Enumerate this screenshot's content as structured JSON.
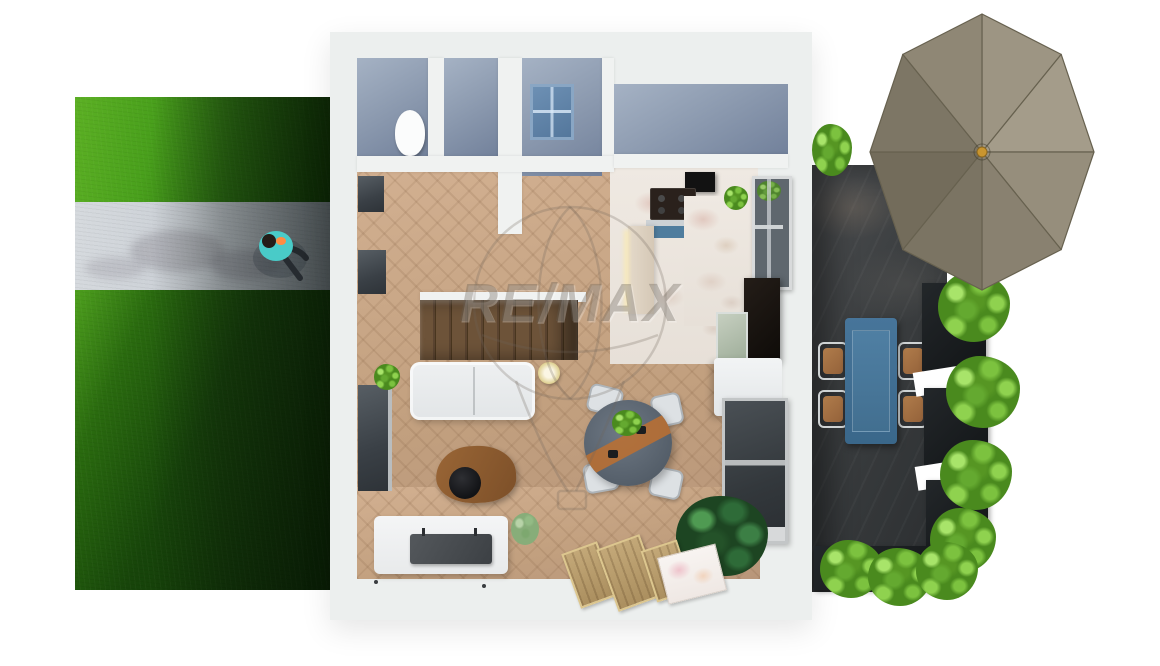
{
  "watermark": {
    "brand": "RE/MAX"
  },
  "scene": {
    "description": "Top-down 3D dollhouse render of a furnished ground floor with left garden lawn and concrete path, central apartment, right patio with outdoor dining set, hedges and a large parasol",
    "colors": {
      "background": "#ffffff",
      "grass_light": "#5cb024",
      "grass_dark": "#123f05",
      "path_concrete": "#c9ced4",
      "house_wall": "#ecefee",
      "room_blue_gray": "#8e9cb1",
      "wood_floor": "#c9a98c",
      "stair_wood": "#5b4430",
      "kitchen_marble": "#e9e2db",
      "patio_dark": "#34373a",
      "planter_black": "#17191b",
      "bush_green": "#6bb637",
      "umbrella_taupe": "#8b8372",
      "umbrella_finial_gold": "#c9952f",
      "outdoor_table_blue": "#3f6e8e",
      "person_shirt_teal": "#49cbc8",
      "coffee_table_wood": "#8a5a2e",
      "runner_orange": "#bd7030",
      "sofa_fabric": "#e9ebec"
    },
    "objects": [
      "garden-lawn",
      "concrete-path",
      "person-walking",
      "exterior-walls",
      "wc-toilet",
      "staircase",
      "skylight-window",
      "landing-room",
      "range-hood",
      "cooktop",
      "kitchen-counter",
      "kitchen-window",
      "fridge-cabinet",
      "kitchen-island",
      "kitchen-sink",
      "sofa",
      "table-lamp",
      "coffee-table",
      "serving-tray",
      "tv-console",
      "television",
      "dining-table",
      "dining-chairs",
      "monstera-plant",
      "door-mats",
      "magazine-mat",
      "sliding-door",
      "patio-table",
      "patio-chairs",
      "garden-umbrella",
      "hedge-planters"
    ]
  }
}
